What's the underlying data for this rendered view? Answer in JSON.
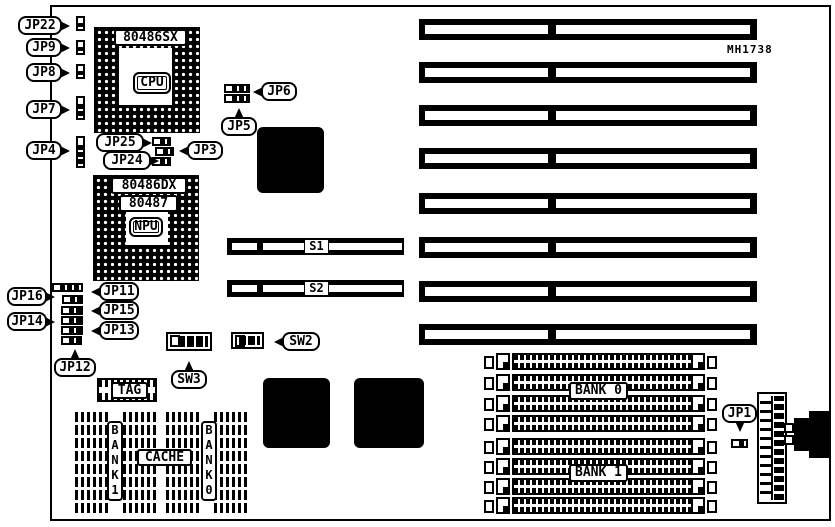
{
  "diagram": {
    "board_model": "MH1738",
    "cpu_socket": {
      "part": "80486SX",
      "core": "CPU"
    },
    "npu_socket": {
      "part": "80486DX",
      "part2": "80487",
      "core": "NPU"
    },
    "jumpers": {
      "jp22": "JP22",
      "jp9": "JP9",
      "jp8": "JP8",
      "jp7": "JP7",
      "jp4": "JP4",
      "jp25": "JP25",
      "jp3": "JP3",
      "jp24": "JP24",
      "jp6": "JP6",
      "jp5": "JP5",
      "jp16": "JP16",
      "jp14": "JP14",
      "jp11": "JP11",
      "jp15": "JP15",
      "jp13": "JP13",
      "jp12": "JP12",
      "jp1": "JP1"
    },
    "switches": {
      "s1": "S1",
      "s2": "S2",
      "sw3": "SW3",
      "sw2": "SW2"
    },
    "cache": {
      "tag": "TAG",
      "label": "CACHE",
      "bank1_vertical": "BANK1",
      "bank0_vertical": "BANK0"
    },
    "memory": {
      "bank0": "BANK 0",
      "bank1": "BANK 1"
    }
  }
}
